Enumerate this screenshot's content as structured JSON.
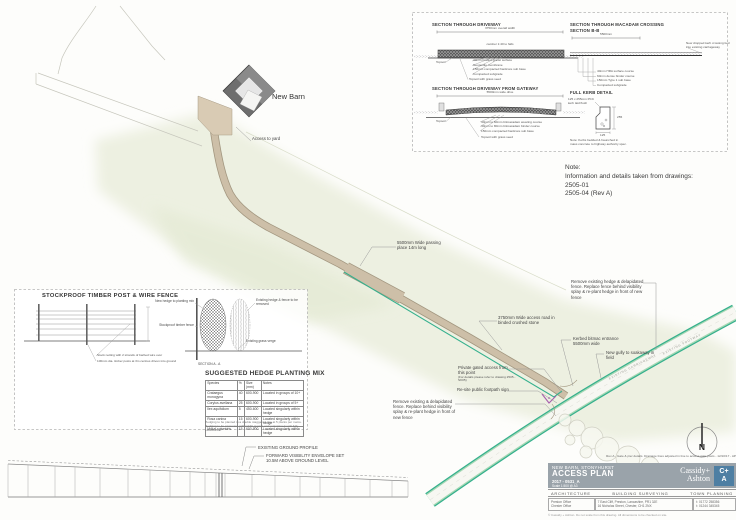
{
  "plan": {
    "barn_label": "New Barn",
    "access_yard_label": "Access to yard",
    "annotations": {
      "passing_place": "5500mm Wide passing place 14m long",
      "remove_hedge_top": "Remove existing hedge & delapidated fence. Replace fence behind visibility splay & re-plant hedge in front of new fence",
      "access_road": "3750mm Wide access road in binded crushed stone",
      "kerbed_entrance": "Kerbed bitmac entrance 5500mm wide",
      "gully": "New gully to soakaway in field",
      "private_access": "Private gated access from this point",
      "private_access_sub": "(For details please refer to drawing 2505 - SK05)",
      "footpath_sign": "Re-site public footpath sign",
      "remove_fence_bottom": "Remove existing & delapidated fence. Replace behind visibility splay & re-plant hedge in front of new fence"
    },
    "road_labels": {
      "carriageway": "EXISTING CARRIAGEWAY",
      "verge": "EXISTING FOOTWAY"
    }
  },
  "note": {
    "title": "Note:",
    "line1": "Information and details taken from drawings:",
    "line2": "2505-01",
    "line3": "2505-04 (Rev A)"
  },
  "sections": {
    "s1": {
      "title": "SECTION THROUGH DRIVEWAY",
      "dim": "3750mm overall width",
      "camber": "camber 1:40 to falls",
      "topsoil": "Topsoil",
      "labels": [
        "40mm binded gravel surface",
        "Geotextile membrane",
        "150mm compacted hardcore sub base",
        "Compacted subgrade"
      ],
      "bottom": "Topsoil with grass seed"
    },
    "s2": {
      "title": "SECTION THROUGH MACADAM CROSSING",
      "subtitle": "SECTION B-B",
      "dim": "5500mm",
      "side_note": "New dropped kerb crossing tied into existing carriageway",
      "labels": [
        "40mm HRA surface course",
        "60mm dense binder course",
        "150mm Type 1 sub base",
        "Compacted subgrade"
      ]
    },
    "s3": {
      "title": "SECTION THROUGH DRIVEWAY FROM GATEWAY",
      "dim": "5500mm wide drive",
      "topsoil": "Topsoil",
      "labels": [
        "40mm to 60mm bitmacadam wearing course",
        "40mm to 80mm bitmacadam binder course",
        "150mm compacted hardcore sub base"
      ],
      "bottom": "Topsoil with grass seed"
    },
    "s4": {
      "title": "FULL KERB DETAIL",
      "kerb_label": "125 x 255mm PCC kerb laid flush",
      "dim_h": "255",
      "dim_w": "125",
      "note1": "Note: Kerbs bedded & haunched in",
      "note2": "mass concrete to highway authority spec."
    }
  },
  "fence_panel": {
    "title": "STOCKPROOF TIMBER POST & WIRE FENCE",
    "wire_label": "Stock netting with 2 strands of barbed wire over",
    "post_label": "100mm dia. timber posts at 3m centres driven into ground",
    "new_hedge": "New hedge to planting mix",
    "fence_ref": "Stockproof timber fence",
    "existing_hedge": "Existing hedge & fence to be removed",
    "verge": "Existing grass verge",
    "section_ref": "SECTION A - A"
  },
  "hedge_table": {
    "title": "SUGGESTED HEDGE PLANTING MIX",
    "headers": [
      "Species",
      "%",
      "Size (mm)",
      "Notes"
    ],
    "rows": [
      [
        "Crataegus monogyna",
        "40",
        "600-900",
        "Located in groups of 10+"
      ],
      [
        "Corylus avellana",
        "25",
        "600-900",
        "Located in groups of 5+"
      ],
      [
        "Ilex aquifolium",
        "5",
        "450-600",
        "Located singularly within hedge"
      ],
      [
        "Rosa canina",
        "15",
        "600-900",
        "Located singularly within hedge"
      ],
      [
        "Malus sylvestris",
        "15",
        "600-900",
        "Located singularly within hedge"
      ]
    ],
    "footnote": "Hedging to be planted in a double staggered row at 5 plants per metre. Hedging to be protected with rabbit guards and maintained until fully established."
  },
  "profile": {
    "label1": "EXISTING GROUND PROFILE",
    "label2": "FORWARD VISIBILITY ENVELOPE SET",
    "label3": "10.5M ABOVE GROUND LEVEL"
  },
  "compass": {
    "north": "N"
  },
  "titleblock": {
    "revision_note": "Rev A - Gate & pier details. Drainage lines adjusted in line to access gate posts - 12/10/17 - AP",
    "project": "NEW BARN, STONYHURST",
    "drawing_title": "ACCESS PLAN",
    "drawing_number": "2017 - 0531_A",
    "scale": "Scale 1:500 @ A3",
    "brand_top": "Cassidy+",
    "brand_bottom": "Ashton",
    "logo_top": "C+",
    "logo_bottom": "A",
    "disciplines": [
      "ARCHITECTURE",
      "BUILDING SURVEYING",
      "TOWN PLANNING"
    ],
    "contacts": [
      {
        "l1": "Preston Office",
        "l2": "Chester Office"
      },
      {
        "l1": "7 East Cliff, Preston, Lancashire, PR1 3JE",
        "l2": "16 Nicholas Street, Chester, CH1 2NX"
      },
      {
        "l1": "t: 01772 258356",
        "l2": "t: 01244 345345"
      }
    ],
    "copyright": "© Cassidy + Ashton. Do not scale from this drawing. All dimensions to be checked on site."
  },
  "colors": {
    "wash": "#edf0e1",
    "road_tan": "#cdbfa8",
    "splay_teal": "#35b08d",
    "hedge_green": "#a6d8b4",
    "gate_purple": "#a85fae",
    "band_gray": "#9aa3aa",
    "logo_blue": "#4e7fa3"
  }
}
